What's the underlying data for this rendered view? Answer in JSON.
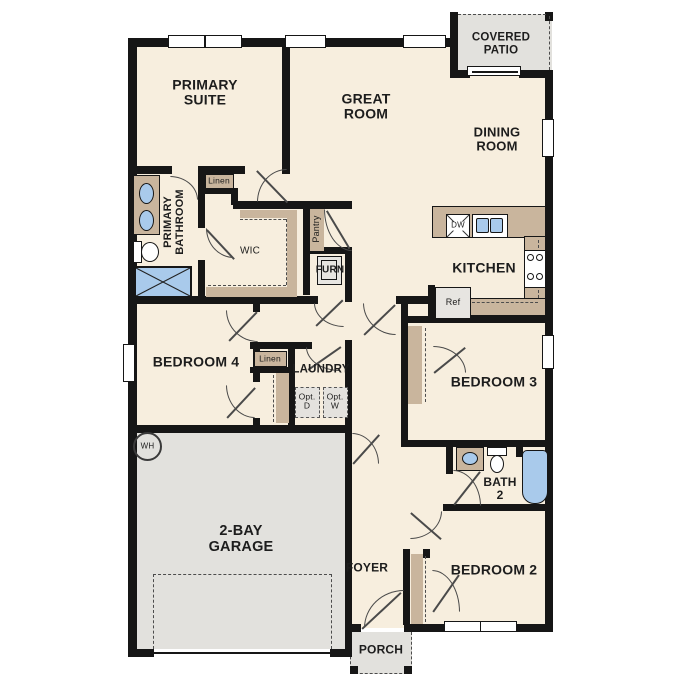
{
  "title": "Single-story floor plan",
  "labels": {
    "primary_suite": "PRIMARY\nSUITE",
    "great_room": "GREAT\nROOM",
    "covered_patio": "COVERED\nPATIO",
    "dining_room": "DINING\nROOM",
    "kitchen": "KITCHEN",
    "primary_bathroom": "PRIMARY\nBATHROOM",
    "wic": "WIC",
    "linen_1": "Linen",
    "linen_2": "Linen",
    "pantry": "Pantry",
    "furnace": "FURN",
    "bedroom_4": "BEDROOM 4",
    "laundry": "LAUNDRY",
    "opt_dryer": "Opt.\nD",
    "opt_washer": "Opt.\nW",
    "water_heater": "WH",
    "garage": "2-BAY\nGARAGE",
    "bedroom_3": "BEDROOM 3",
    "bath_2": "BATH\n2",
    "bedroom_2": "BEDROOM 2",
    "foyer": "FOYER",
    "porch": "PORCH",
    "dishwasher": "DW",
    "refrigerator": "Ref"
  },
  "fixtures": [
    "double-vanity",
    "toilet",
    "shower",
    "tub",
    "kitchen-sink",
    "dishwasher",
    "range",
    "refrigerator",
    "bath-vanity",
    "water-heater",
    "furnace",
    "washer-opt",
    "dryer-opt"
  ],
  "colors": {
    "wall": "#161616",
    "floor": "#f7eede",
    "casework_tan": "#c9b59d",
    "hard_floor_gray": "#e2e1dd",
    "fixture_blue": "#a9caeb",
    "appliance_gray": "#e7e5e1"
  }
}
